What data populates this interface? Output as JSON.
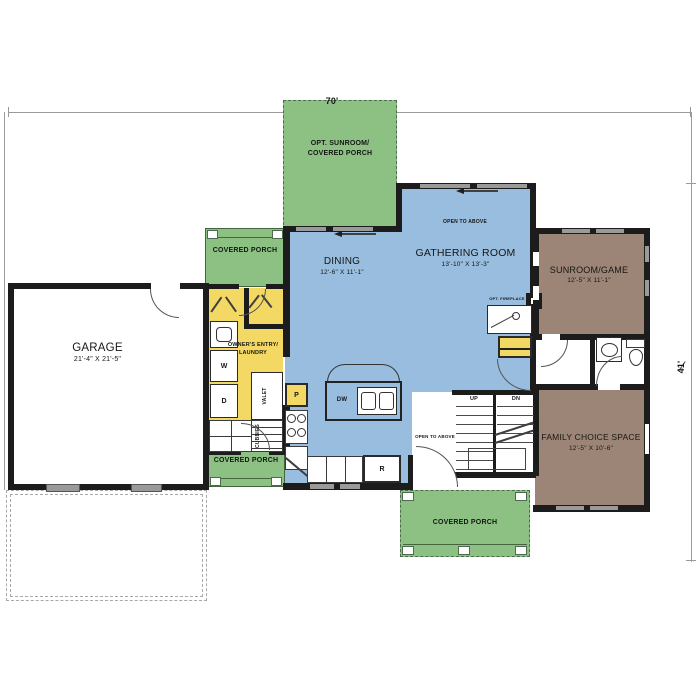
{
  "dimensions": {
    "width": "70'",
    "depth": "41'"
  },
  "rooms": {
    "garage": {
      "name": "GARAGE",
      "size": "21'-4\" x 21'-5\""
    },
    "dining": {
      "name": "DINING",
      "size": "12'-6\" x 11'-1\""
    },
    "gathering_room": {
      "name": "GATHERING ROOM",
      "size": "13'-10\" x 13'-3\""
    },
    "sunroom_game": {
      "name": "SUNROOM/GAME",
      "size": "12'-5\" x 11'-1\""
    },
    "family_choice_space": {
      "name": "FAMILY CHOICE SPACE",
      "size": "12'-5\" x 10'-6\""
    },
    "owners_entry_laundry": {
      "line1": "OWNER'S ENTRY/",
      "line2": "LAUNDRY"
    },
    "opt_sunroom": {
      "line1": "OPT. SUNROOM/",
      "line2": "COVERED PORCH"
    },
    "covered_porch_upper": {
      "name": "COVERED PORCH"
    },
    "covered_porch_lower": {
      "name": "COVERED PORCH"
    },
    "covered_porch_rear": {
      "name": "COVERED PORCH"
    }
  },
  "annotations": {
    "open_to_above_gathering": "OPEN TO ABOVE",
    "open_to_above_stair": "OPEN TO ABOVE",
    "opt_fireplace": "OPT. FIREPLACE",
    "half_wall": "HALF WALL W/ WOOD CAP",
    "up": "UP",
    "dn": "DN",
    "washer": "W",
    "dryer": "D",
    "pantry": "P",
    "range": "R",
    "dishwasher": "DW",
    "valet": "VALET",
    "cubbies": "CUBBIES"
  },
  "colors": {
    "porch_green": "#8CC183",
    "room_blue": "#98BDDE",
    "room_brown": "#9C8577",
    "accent_yellow": "#F3D963",
    "wall_black": "#1C1C1C",
    "thin_line": "#9A9A9A",
    "window_gray": "#9A9A9A"
  }
}
